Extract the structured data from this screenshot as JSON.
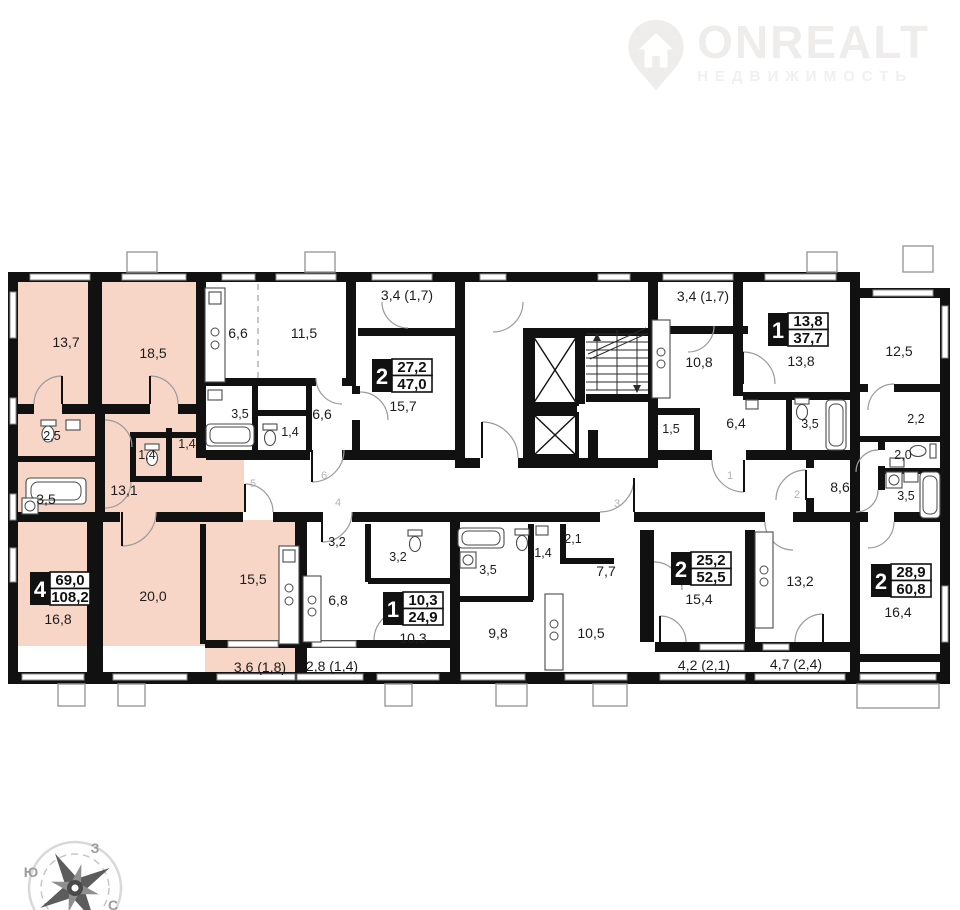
{
  "logo": {
    "brand": "ONREALT",
    "subtitle": "НЕДВИЖИМОСТЬ"
  },
  "apartments": [
    {
      "name": "apt-4-room",
      "rooms": "4",
      "living_area": "69,0",
      "total_area": "108,2",
      "highlighted": true
    },
    {
      "name": "apt-2-room-a",
      "rooms": "2",
      "living_area": "27,2",
      "total_area": "47,0",
      "highlighted": false
    },
    {
      "name": "apt-1-room-a",
      "rooms": "1",
      "living_area": "13,8",
      "total_area": "37,7",
      "highlighted": false
    },
    {
      "name": "apt-1-room-b",
      "rooms": "1",
      "living_area": "10,3",
      "total_area": "24,9",
      "highlighted": false
    },
    {
      "name": "apt-2-room-b",
      "rooms": "2",
      "living_area": "25,2",
      "total_area": "52,5",
      "highlighted": false
    },
    {
      "name": "apt-2-room-c",
      "rooms": "2",
      "living_area": "28,9",
      "total_area": "60,8",
      "highlighted": false
    }
  ],
  "room_labels": [
    {
      "text": "13,7"
    },
    {
      "text": "18,5"
    },
    {
      "text": "2,5"
    },
    {
      "text": "1,4"
    },
    {
      "text": "1,4"
    },
    {
      "text": "3,5"
    },
    {
      "text": "13,1"
    },
    {
      "text": "16,8"
    },
    {
      "text": "20,0"
    },
    {
      "text": "15,5"
    },
    {
      "text": "3,6 (1,8)"
    },
    {
      "text": "6,6"
    },
    {
      "text": "11,5"
    },
    {
      "text": "3,4 (1,7)"
    },
    {
      "text": "3,5"
    },
    {
      "text": "1,4"
    },
    {
      "text": "6,6"
    },
    {
      "text": "15,7"
    },
    {
      "text": "3,4 (1,7)"
    },
    {
      "text": "10,8"
    },
    {
      "text": "1,5"
    },
    {
      "text": "6,4"
    },
    {
      "text": "13,8"
    },
    {
      "text": "3,5"
    },
    {
      "text": "12,5"
    },
    {
      "text": "2,2"
    },
    {
      "text": "2,0"
    },
    {
      "text": "3,5"
    },
    {
      "text": "8,6"
    },
    {
      "text": "13,2"
    },
    {
      "text": "16,4"
    },
    {
      "text": "3,2"
    },
    {
      "text": "3,2"
    },
    {
      "text": "6,8"
    },
    {
      "text": "10,3"
    },
    {
      "text": "2,8 (1,4)"
    },
    {
      "text": "3,5"
    },
    {
      "text": "1,4"
    },
    {
      "text": "2,1"
    },
    {
      "text": "7,7"
    },
    {
      "text": "9,8"
    },
    {
      "text": "10,5"
    },
    {
      "text": "15,4"
    },
    {
      "text": "4,2 (2,1)"
    },
    {
      "text": "4,7 (2,4)"
    }
  ],
  "unit_doors": [
    {
      "number": "5"
    },
    {
      "number": "6"
    },
    {
      "number": "4"
    },
    {
      "number": "3"
    },
    {
      "number": "1"
    },
    {
      "number": "2"
    }
  ],
  "compass": {
    "west": "З",
    "south": "Ю",
    "north": "С"
  },
  "colors": {
    "highlight": "#f8d6c7",
    "wall": "#111111"
  }
}
